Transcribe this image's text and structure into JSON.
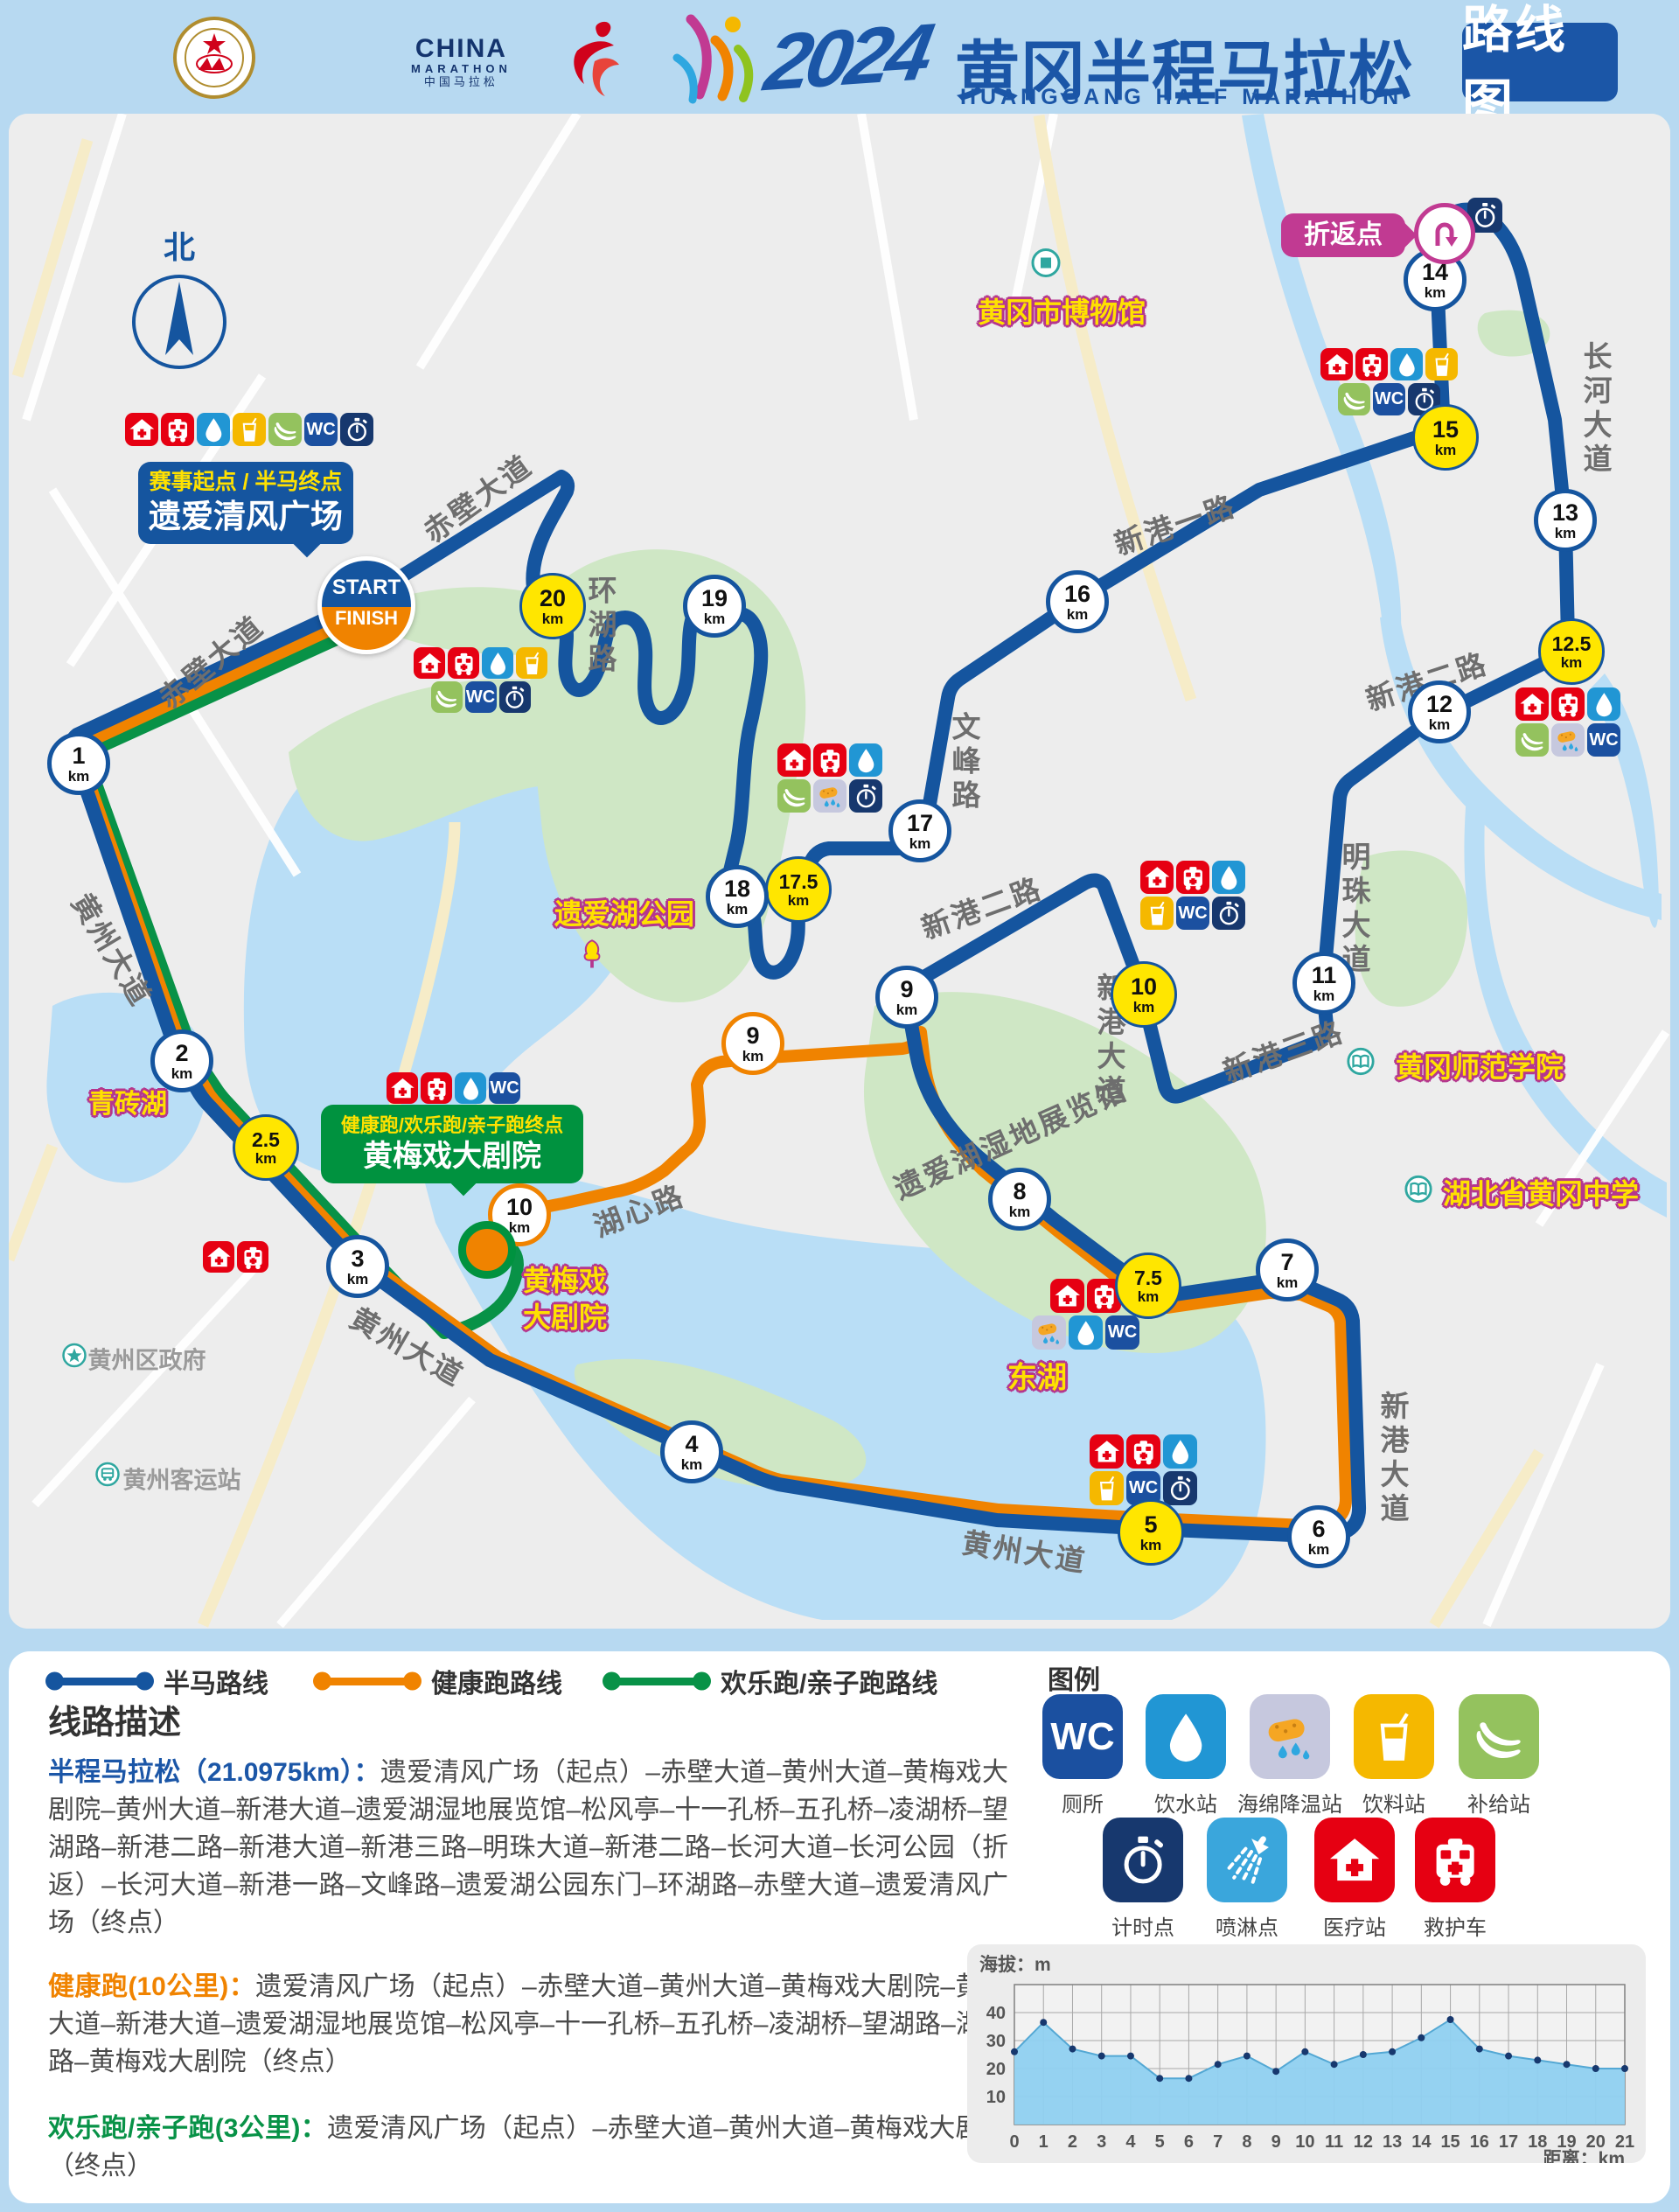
{
  "header": {
    "assoc_ring_text": "CHINESE ATHLETICS ASSOCIATION",
    "assoc_cn": "中国田径协会",
    "china_marathon_en": "CHINA",
    "china_marathon_sub": "MARATHON",
    "china_marathon_cn": "中国马拉松",
    "year": "2024",
    "title_cn": "黄冈半程马拉松",
    "title_en": "HUANGGANG HALF MARATHON",
    "badge": "路线图"
  },
  "icon_text": {
    "wc": "WC"
  },
  "marker_unit": "km",
  "map": {
    "compass": "北",
    "start_label": "START",
    "finish_label": "FINISH",
    "callouts": {
      "start_line1": "赛事起点 / 半马终点",
      "start_line2": "遗爱清风广场",
      "turnaround": "折返点",
      "theater_line1": "健康跑/欢乐跑/亲子跑终点",
      "theater_line2": "黄梅戏大剧院"
    },
    "roads": [
      {
        "text": "赤壁大道",
        "x": 240,
        "y": 755,
        "rot": -40
      },
      {
        "text": "赤壁大道",
        "x": 545,
        "y": 568,
        "rot": -36
      },
      {
        "text": "环湖路",
        "x": 686,
        "y": 716,
        "vertical": true
      },
      {
        "text": "黄州大道",
        "x": 130,
        "y": 1085,
        "rot": 59
      },
      {
        "text": "黄州大道",
        "x": 467,
        "y": 1538,
        "rot": 30
      },
      {
        "text": "黄州大道",
        "x": 1172,
        "y": 1772,
        "rot": 9
      },
      {
        "text": "文峰路",
        "x": 1102,
        "y": 872,
        "vertical": true
      },
      {
        "text": "新港一路",
        "x": 1343,
        "y": 598,
        "rot": -19
      },
      {
        "text": "新港二路",
        "x": 1631,
        "y": 777,
        "rot": -18
      },
      {
        "text": "新港二路",
        "x": 1122,
        "y": 1036,
        "rot": -20
      },
      {
        "text": "长河大道",
        "x": 1824,
        "y": 468,
        "vertical": true
      },
      {
        "text": "明珠大道",
        "x": 1548,
        "y": 1040,
        "vertical": true
      },
      {
        "text": "新港大道",
        "x": 1268,
        "y": 1190,
        "vertical": true
      },
      {
        "text": "新港大道",
        "x": 1592,
        "y": 1668,
        "vertical": true
      },
      {
        "text": "新港三路",
        "x": 1467,
        "y": 1200,
        "rot": -20
      },
      {
        "text": "湖心路",
        "x": 730,
        "y": 1382,
        "rot": -21
      },
      {
        "text": "遗爱湖湿地展览馆",
        "x": 1155,
        "y": 1300,
        "rot": -24
      }
    ],
    "landmarks": [
      {
        "text": "黄冈市博物馆",
        "x": 1214,
        "y": 355,
        "icon": "museum",
        "ix": 1196,
        "iy": 303
      },
      {
        "text": "遗爱湖公园",
        "x": 714,
        "y": 1043,
        "icon": "tree",
        "ix": 677,
        "iy": 1094
      },
      {
        "text": "青砖湖",
        "x": 146,
        "y": 1259,
        "size": 30
      },
      {
        "text": "黄梅戏",
        "x": 646,
        "y": 1462
      },
      {
        "text": "大剧院",
        "x": 646,
        "y": 1504
      },
      {
        "text": "东湖",
        "x": 1186,
        "y": 1572,
        "size": 34
      },
      {
        "text": "黄冈师范学院",
        "x": 1692,
        "y": 1218,
        "icon": "book",
        "ix": 1556,
        "iy": 1216
      },
      {
        "text": "湖北省黄冈中学",
        "x": 1762,
        "y": 1363,
        "icon": "book",
        "ix": 1622,
        "iy": 1362
      }
    ],
    "gray_landmarks": [
      {
        "text": "黄州区政府",
        "x": 168,
        "y": 1553,
        "icon": "star",
        "ix": 85,
        "iy": 1552
      },
      {
        "text": "黄州客运站",
        "x": 208,
        "y": 1690,
        "icon": "busstop",
        "ix": 123,
        "iy": 1688
      }
    ],
    "markers": [
      {
        "num": "1",
        "x": 90,
        "y": 873,
        "type": "half"
      },
      {
        "num": "2",
        "x": 208,
        "y": 1213,
        "type": "half"
      },
      {
        "num": "2.5",
        "x": 304,
        "y": 1312,
        "type": "special"
      },
      {
        "num": "3",
        "x": 409,
        "y": 1448,
        "type": "half"
      },
      {
        "num": "4",
        "x": 791,
        "y": 1660,
        "type": "half"
      },
      {
        "num": "5",
        "x": 1316,
        "y": 1752,
        "type": "special"
      },
      {
        "num": "6",
        "x": 1508,
        "y": 1757,
        "type": "half"
      },
      {
        "num": "7",
        "x": 1472,
        "y": 1452,
        "type": "half"
      },
      {
        "num": "7.5",
        "x": 1313,
        "y": 1470,
        "type": "special"
      },
      {
        "num": "8",
        "x": 1166,
        "y": 1371,
        "type": "half"
      },
      {
        "num": "9",
        "x": 1037,
        "y": 1140,
        "type": "half"
      },
      {
        "num": "9",
        "x": 861,
        "y": 1193,
        "type": "health"
      },
      {
        "num": "10",
        "x": 1308,
        "y": 1137,
        "type": "special"
      },
      {
        "num": "10",
        "x": 594,
        "y": 1389,
        "type": "health"
      },
      {
        "num": "11",
        "x": 1514,
        "y": 1124,
        "type": "half"
      },
      {
        "num": "12",
        "x": 1646,
        "y": 814,
        "type": "half"
      },
      {
        "num": "12.5",
        "x": 1797,
        "y": 745,
        "type": "special"
      },
      {
        "num": "13",
        "x": 1790,
        "y": 595,
        "type": "half"
      },
      {
        "num": "14",
        "x": 1641,
        "y": 320,
        "type": "half"
      },
      {
        "num": "15",
        "x": 1653,
        "y": 500,
        "type": "special"
      },
      {
        "num": "16",
        "x": 1232,
        "y": 688,
        "type": "half"
      },
      {
        "num": "17",
        "x": 1052,
        "y": 950,
        "type": "half"
      },
      {
        "num": "17.5",
        "x": 913,
        "y": 1017,
        "type": "special"
      },
      {
        "num": "18",
        "x": 843,
        "y": 1025,
        "type": "half"
      },
      {
        "num": "19",
        "x": 817,
        "y": 693,
        "type": "half"
      },
      {
        "num": "20",
        "x": 632,
        "y": 693,
        "type": "special"
      }
    ],
    "icon_clusters": [
      {
        "x": 143,
        "y": 472,
        "size": 38,
        "rows": [
          [
            "medical",
            "ambulance",
            "water",
            "drink",
            "banana",
            "wc",
            "timer"
          ]
        ]
      },
      {
        "x": 473,
        "y": 740,
        "size": 36,
        "rows": [
          [
            "medical",
            "ambulance",
            "water",
            "drink"
          ],
          [
            "banana",
            "wc",
            "timer"
          ]
        ]
      },
      {
        "x": 889,
        "y": 850,
        "size": 38,
        "rows": [
          [
            "medical",
            "ambulance",
            "water"
          ],
          [
            "banana",
            "sponge",
            "timer"
          ]
        ]
      },
      {
        "x": 1510,
        "y": 398,
        "size": 37,
        "rows": [
          [
            "medical",
            "ambulance",
            "water",
            "drink"
          ],
          [
            "banana",
            "wc",
            "timer"
          ]
        ]
      },
      {
        "x": 1733,
        "y": 786,
        "size": 38,
        "rows": [
          [
            "medical",
            "ambulance",
            "water"
          ],
          [
            "banana",
            "sponge",
            "wc"
          ]
        ]
      },
      {
        "x": 1304,
        "y": 984,
        "size": 38,
        "rows": [
          [
            "medical",
            "ambulance",
            "water"
          ],
          [
            "drink",
            "wc",
            "timer"
          ]
        ]
      },
      {
        "x": 1180,
        "y": 1462,
        "size": 39,
        "rows": [
          [
            "medical",
            "ambulance"
          ],
          [
            "sponge",
            "water",
            "wc"
          ]
        ]
      },
      {
        "x": 1246,
        "y": 1640,
        "size": 39,
        "rows": [
          [
            "medical",
            "ambulance",
            "water"
          ],
          [
            "drink",
            "wc",
            "timer"
          ]
        ]
      },
      {
        "x": 232,
        "y": 1419,
        "size": 36,
        "rows": [
          [
            "medical",
            "ambulance"
          ]
        ]
      },
      {
        "x": 442,
        "y": 1226,
        "size": 36,
        "rows": [
          [
            "medical",
            "ambulance",
            "water",
            "wc"
          ]
        ]
      },
      {
        "x": 1678,
        "y": 226,
        "size": 40,
        "rows": [
          [
            "timer"
          ]
        ]
      }
    ]
  },
  "panel": {
    "route_legend": [
      {
        "label": "半马路线",
        "color": "#15559f",
        "x": 45
      },
      {
        "label": "健康跑路线",
        "color": "#f08300",
        "x": 351
      },
      {
        "label": "欢乐跑/亲子跑路线",
        "color": "#089247",
        "x": 682
      }
    ],
    "desc_title": "线路描述",
    "descriptions": [
      {
        "lead": "半程马拉松（21.0975km）：",
        "color": "#1b56a7",
        "top": 117,
        "body": "遗爱清风广场（起点）–赤壁大道–黄州大道–黄梅戏大剧院–黄州大道–新港大道–遗爱湖湿地展览馆–松风亭–十一孔桥–五孔桥–凌湖桥–望湖路–新港二路–新港大道–新港三路–明珠大道–新港二路–长河大道–长河公园（折返）–长河大道–新港一路–文峰路–遗爱湖公园东门–环湖路–赤壁大道–遗爱清风广场（终点）"
      },
      {
        "lead": "健康跑(10公里)：",
        "color": "#f08300",
        "top": 362,
        "body": "遗爱清风广场（起点）–赤壁大道–黄州大道–黄梅戏大剧院–黄州大道–新港大道–遗爱湖湿地展览馆–松风亭–十一孔桥–五孔桥–凌湖桥–望湖路–湖心路–黄梅戏大剧院（终点）"
      },
      {
        "lead": "欢乐跑/亲子跑(3公里)：",
        "color": "#089247",
        "top": 524,
        "body": "遗爱清风广场（起点）–赤壁大道–黄州大道–黄梅戏大剧院（终点）"
      }
    ],
    "legend_title": "图例",
    "legend_row1": [
      {
        "name": "wc",
        "label": "厕所",
        "cx": 1228
      },
      {
        "name": "water",
        "label": "饮水站",
        "cx": 1346
      },
      {
        "name": "sponge",
        "label": "海绵降温站",
        "cx": 1465
      },
      {
        "name": "drink",
        "label": "饮料站",
        "cx": 1584
      },
      {
        "name": "banana",
        "label": "补给站",
        "cx": 1704
      }
    ],
    "legend_row2": [
      {
        "name": "timer",
        "label": "计时点",
        "cx": 1297
      },
      {
        "name": "shower",
        "label": "喷淋点",
        "cx": 1416
      },
      {
        "name": "medical",
        "label": "医疗站",
        "cx": 1539
      },
      {
        "name": "ambulance",
        "label": "救护车",
        "cx": 1654
      }
    ]
  },
  "chart_data": {
    "type": "area",
    "title": "海拔：m",
    "xlabel": "距离：km",
    "x": [
      0,
      1,
      2,
      3,
      4,
      5,
      6,
      7,
      8,
      9,
      10,
      11,
      12,
      13,
      14,
      15,
      16,
      17,
      18,
      19,
      20,
      21
    ],
    "values": [
      26,
      36.5,
      27,
      24.5,
      24.5,
      16.5,
      16.5,
      21.5,
      24.5,
      19,
      26,
      21.5,
      25,
      26,
      31,
      37.5,
      27,
      24.5,
      23,
      21.5,
      20,
      20
    ],
    "ylim": [
      0,
      50
    ],
    "yticks": [
      10,
      20,
      30,
      40
    ],
    "grid": true,
    "fill_color": "#8fd0f0",
    "line_color": "#54a8d4",
    "dot_color": "#17386e"
  }
}
